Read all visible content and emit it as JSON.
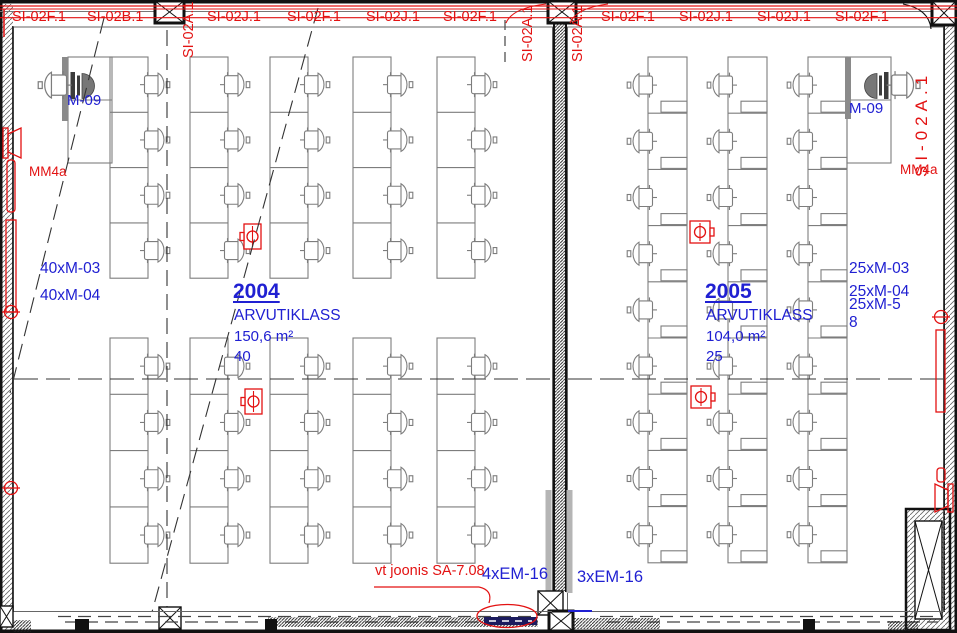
{
  "title": "Korruseplaan — arvutiklassid 2004 ja 2005",
  "colors": {
    "annotation_red": "#e31212",
    "annotation_blue": "#2020d2",
    "furniture_gray": "#7d7d7d",
    "wall_black": "#111111",
    "em_fixture_navy": "#1b1b5e",
    "hatch_gray": "#555555"
  },
  "top_labels": [
    "SI-02F.1",
    "SI-02B.1",
    "SI-02A.1",
    "SI-02J.1",
    "SI-02F.1",
    "SI-02J.1",
    "SI-02F.1",
    "SI-02A.1",
    "SI-02A.1",
    "SI-02F.1",
    "SI-02J.1",
    "SI-02J.1",
    "SI-02F.1",
    "SI-02A.1"
  ],
  "rooms": [
    {
      "number": "2004",
      "name": "ARVUTIKLASS",
      "area": "150,6 m²",
      "seat_count": "40",
      "workstation_label": "M-09",
      "equipment_lines": [
        "40xM-03",
        "40xM-04"
      ]
    },
    {
      "number": "2005",
      "name": "ARVUTIKLASS",
      "area": "104,0 m²",
      "seat_count": "25",
      "workstation_label": "M-09",
      "equipment_lines": [
        "25xM-03",
        "25xM-04",
        "25xM-5",
        "8"
      ]
    }
  ],
  "wall_markers": {
    "left": "MM4a",
    "right": "MM4a"
  },
  "annotations": {
    "reference_note": "vt joonis SA-7.08",
    "emergency_left": "4xEM-16",
    "emergency_right": "3xEM-16"
  },
  "legend": {
    "floor_outlet": "floor-outlet-symbol",
    "wall_speaker": "wall-speaker-symbol",
    "structural_column": "column-x-symbol",
    "teacher_station": "teacher-workstation-symbol"
  }
}
